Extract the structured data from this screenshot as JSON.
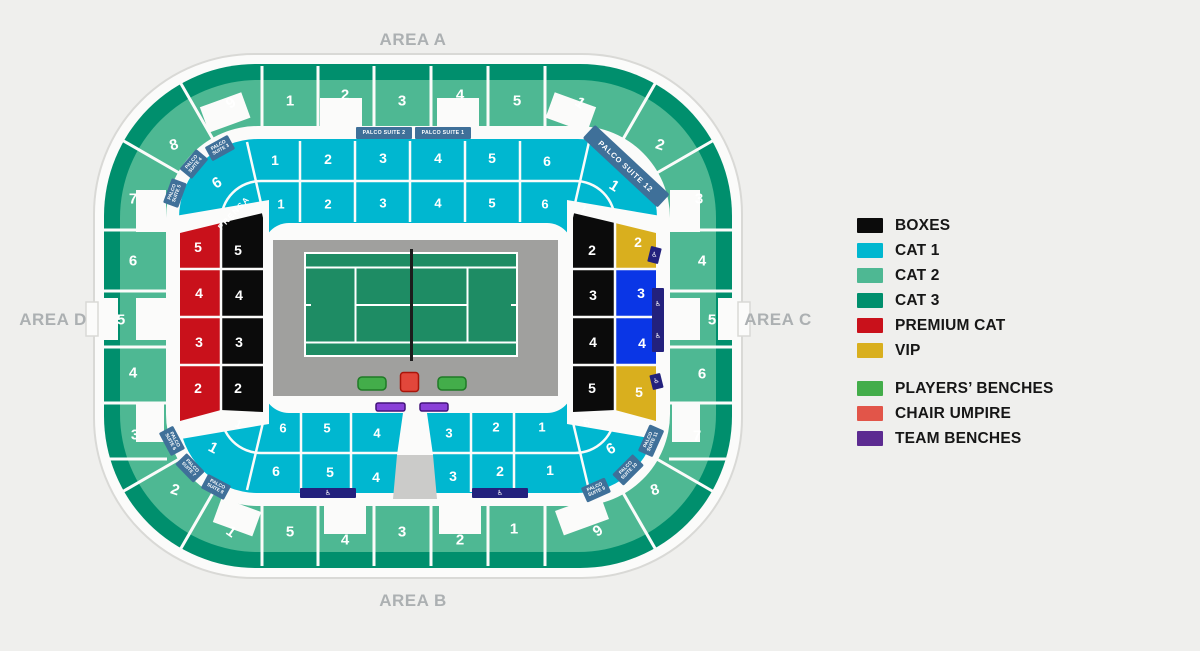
{
  "areas": {
    "top": "AREA A",
    "bottom": "AREA B",
    "left": "AREA D",
    "right": "AREA C"
  },
  "legend": {
    "groups": [
      {
        "items": [
          {
            "label": "BOXES",
            "color": "#0b0b0b"
          },
          {
            "label": "CAT 1",
            "color": "#00b7d0"
          },
          {
            "label": "CAT 2",
            "color": "#4eb893"
          },
          {
            "label": "CAT 3",
            "color": "#008f6d"
          },
          {
            "label": "PREMIUM CAT",
            "color": "#c9111b"
          },
          {
            "label": "VIP",
            "color": "#d9af1e"
          }
        ]
      },
      {
        "items": [
          {
            "label": "PLAYERS’ BENCHES",
            "color": "#43ad4a"
          },
          {
            "label": "CHAIR UMPIRE",
            "color": "#e25549"
          },
          {
            "label": "TEAM BENCHES",
            "color": "#5c2b91"
          }
        ]
      }
    ]
  },
  "sections": {
    "cat2": {
      "top": [
        "1",
        "2",
        "3",
        "4",
        "5"
      ],
      "right": [
        "1",
        "2",
        "3",
        "4",
        "5",
        "6",
        "7",
        "8",
        "9"
      ],
      "bottom": [
        "5",
        "4",
        "3",
        "2",
        "1"
      ],
      "left": [
        "9",
        "8",
        "7",
        "6",
        "5",
        "4",
        "3",
        "2",
        "1"
      ]
    },
    "cat1": {
      "top_outer": [
        "1",
        "2",
        "3",
        "4",
        "5",
        "6"
      ],
      "top_inner": [
        "1",
        "2",
        "3",
        "4",
        "5",
        "6"
      ],
      "bottom_inner": [
        "6",
        "5",
        "4",
        "3",
        "2",
        "1"
      ],
      "bottom_outer": [
        "6",
        "5",
        "4",
        "3",
        "2",
        "1"
      ],
      "corner_tl": [
        "6"
      ],
      "corner_tr": [
        "1",
        "1"
      ],
      "corner_bl": [
        "1",
        "1"
      ],
      "corner_br": [
        "6",
        "6"
      ]
    },
    "boxes": {
      "left": [
        "5",
        "4",
        "3",
        "2"
      ],
      "right": [
        "2",
        "3",
        "4",
        "5"
      ]
    },
    "premium": {
      "left": [
        "5",
        "4",
        "3",
        "2"
      ]
    },
    "vip": {
      "right": [
        "2",
        "5"
      ]
    },
    "accessible_cat": {
      "right": [
        "3",
        "4"
      ]
    }
  },
  "suites": {
    "labels": [
      "PALCO SUITE 1",
      "PALCO SUITE 2",
      "PALCO SUITE 3",
      "PALCO SUITE 4",
      "PALCO SUITE 5",
      "PALCO SUITE 6",
      "PALCO SUITE 7",
      "PALCO SUITE 8",
      "PALCO SUITE 9",
      "PALCO SUITE 10",
      "PALCO SUITE 11",
      "PALCO SUITE 12"
    ]
  },
  "press": {
    "label": "PRENSA"
  },
  "icons": {
    "accessible": "♿"
  },
  "colors": {
    "cat1": "#00b7d0",
    "cat2": "#4eb893",
    "cat3": "#008f6d",
    "boxes": "#0b0b0b",
    "premium": "#c9111b",
    "vip": "#d9af1e",
    "accessible_blue": "#0a36e6",
    "accessible_navy": "#23217d",
    "suite": "#3f7099",
    "court_green": "#1e8c64",
    "court_surround": "#a0a09e",
    "bench_green": "#43ad4a",
    "umpire_red": "#e2473b",
    "team_purple": "#8a40d8"
  }
}
